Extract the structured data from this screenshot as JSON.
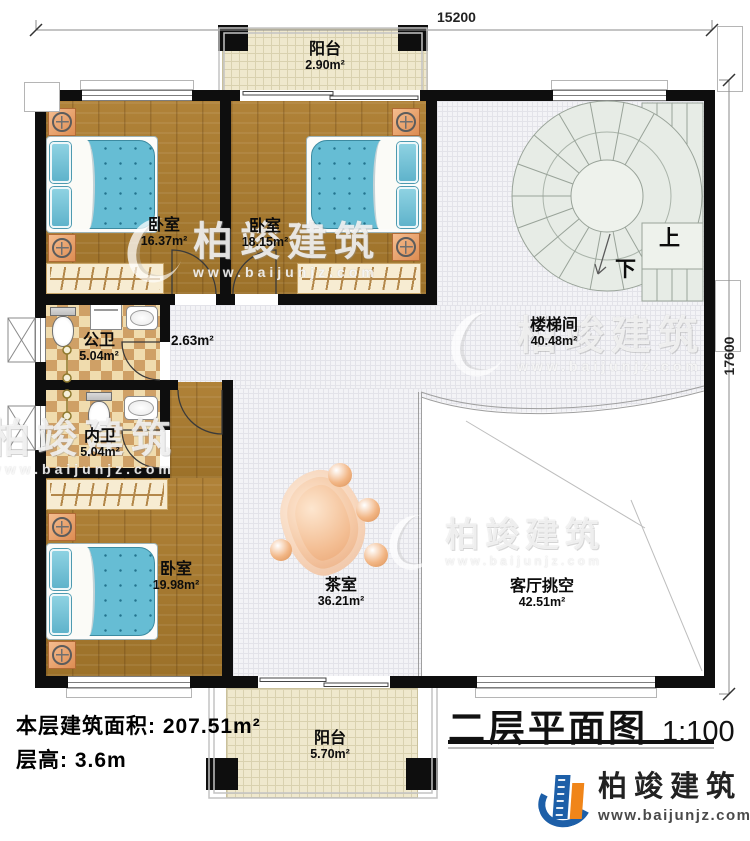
{
  "dimensions": {
    "top": "15200",
    "right": "17600"
  },
  "rooms": [
    {
      "id": "balcony-top",
      "name": "阳台",
      "area": "2.90m²"
    },
    {
      "id": "bedroom-1",
      "name": "卧室",
      "area": "16.37m²"
    },
    {
      "id": "bedroom-2",
      "name": "卧室",
      "area": "18.15m²"
    },
    {
      "id": "corridor",
      "name": "",
      "area": "2.63m²"
    },
    {
      "id": "bath-public",
      "name": "公卫",
      "area": "5.04m²"
    },
    {
      "id": "bath-ensuite",
      "name": "内卫",
      "area": "5.04m²"
    },
    {
      "id": "bedroom-3",
      "name": "卧室",
      "area": "19.98m²"
    },
    {
      "id": "tea-room",
      "name": "茶室",
      "area": "36.21m²"
    },
    {
      "id": "stairwell",
      "name": "楼梯间",
      "area": "40.48m²"
    },
    {
      "id": "living-void",
      "name": "客厅挑空",
      "area": "42.51m²"
    },
    {
      "id": "balcony-bottom",
      "name": "阳台",
      "area": "5.70m²"
    }
  ],
  "stairs": {
    "up": "上",
    "down": "下"
  },
  "footer": {
    "line1": "本层建筑面积: 207.51m²",
    "line2": "层高: 3.6m"
  },
  "title": {
    "text": "二层平面图",
    "scale": "1:100"
  },
  "branding": {
    "name": "柏竣建筑",
    "website": "www.baijunjz.com"
  },
  "watermark": {
    "text": "柏竣建筑",
    "website": "www.baijunjz.com"
  },
  "colors": {
    "wall": "#0e0e0e",
    "wood_floor": "#a87b33",
    "mattress": "#66bdd4",
    "checker_dark": "#cfa066",
    "checker_light": "#f0dcae",
    "hall_floor": "#f3f3f6",
    "balcony_tile": "#efe8cd",
    "stair_fill": "#e7ece6",
    "logo_blue": "#1d5fa8",
    "logo_orange": "#f08519"
  }
}
